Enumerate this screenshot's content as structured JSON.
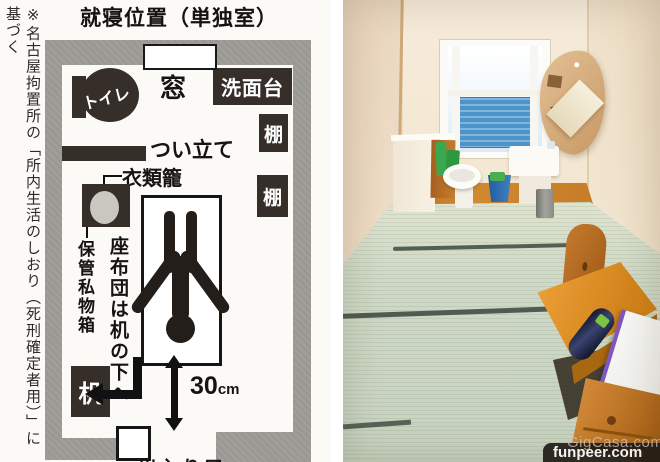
{
  "diagram": {
    "title": "就寝位置（単独室）",
    "source_note": "※名古屋拘置所の「所内生活のしおり（死刑確定者用）」に基づく",
    "labels": {
      "toilet": "トイレ",
      "window": "窓",
      "washstand": "洗面台",
      "shelf_upper": "棚",
      "shelf_lower": "棚",
      "partition": "つい立て",
      "clothes_basket": "衣類籠",
      "storage_box": "保管私物箱",
      "cushion_note": "座布団は机の下へ",
      "desk": "机",
      "distance_value": "30",
      "distance_unit": "cm",
      "entrance": "出入り口"
    }
  },
  "photo": {
    "watermark": "funpeer.com",
    "watermark_background": "GigCasa.com"
  },
  "colors": {
    "wall_gray": "#9a9893",
    "dark_fill": "#352e29",
    "tatami_green": "#ccd6c4",
    "wood_floor": "#c07a2e",
    "desk_wood": "#d98e2b",
    "window_blue": "#4d94cb",
    "room_cream": "#f0e3d0",
    "watermark_pill": "#1c1814"
  }
}
